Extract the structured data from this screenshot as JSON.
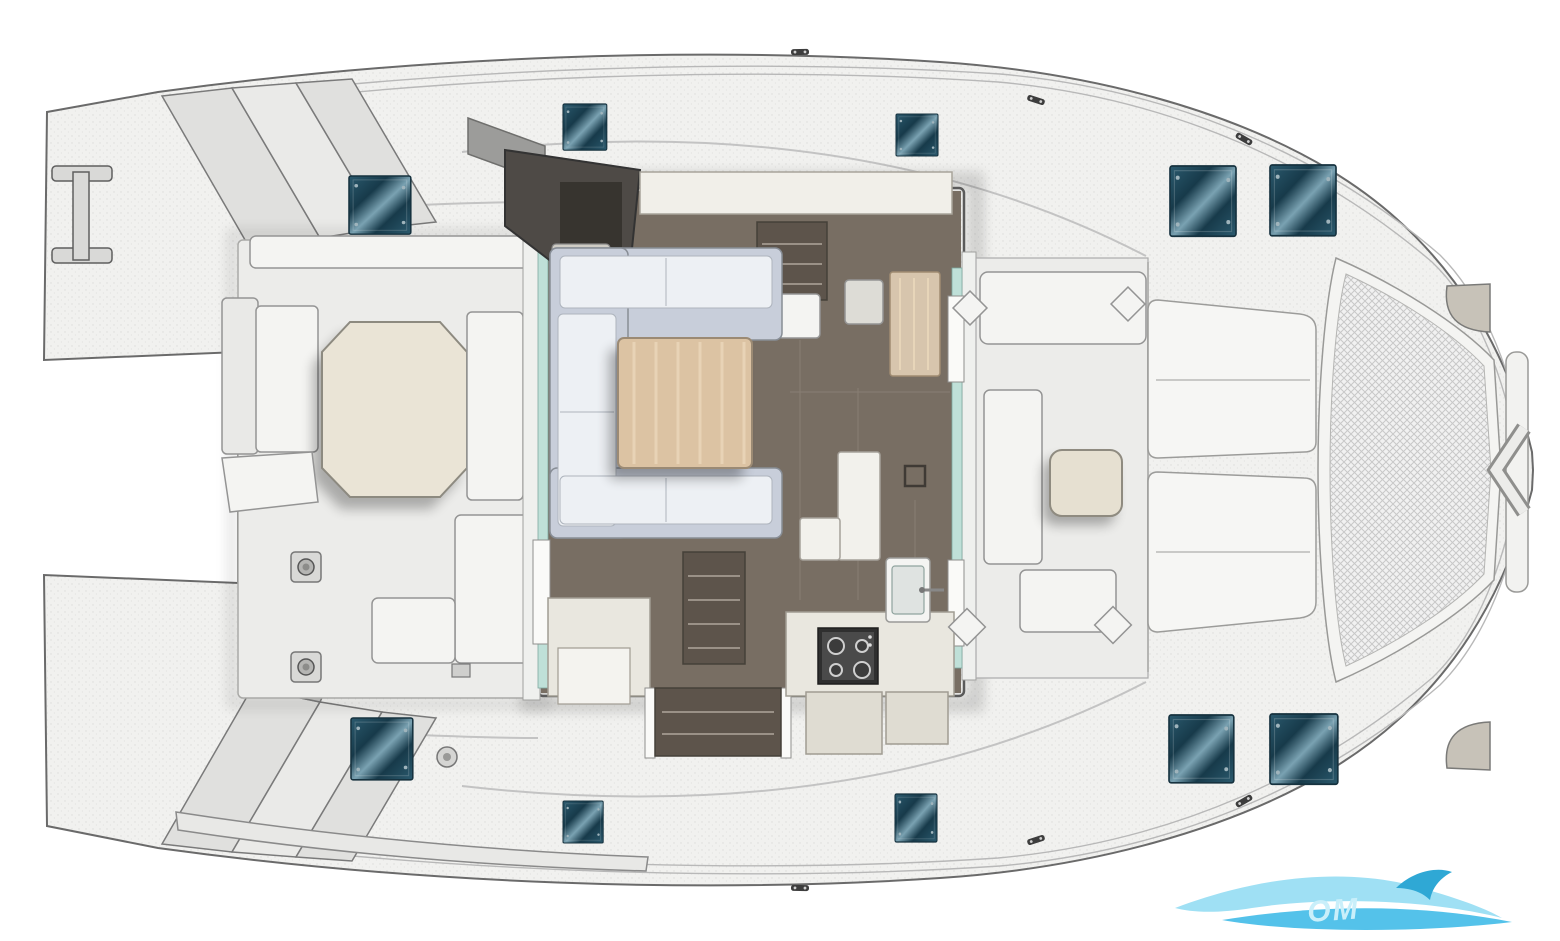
{
  "image": {
    "kind": "boat-deck-floor-plan",
    "subject": "catamaran top view, bow to the right, saloon and cockpits visible"
  },
  "colors": {
    "background": "#ffffff",
    "hull_fill": "#f1f1ef",
    "hull_stroke": "#6a6a6a",
    "deck_speckle": "#dcdcda",
    "cockpit_sole": "#ececea",
    "seat_white": "#f4f4f2",
    "step_gray": "#e0e0de",
    "wedge_gray": "#c2c2c0",
    "salon_floor": "#786e63",
    "floor_seam": "#8d8377",
    "stairs_brown": "#5d544b",
    "sofa_back": "#c8ceda",
    "sofa_cushion": "#edf0f4",
    "salon_table_wood": "#dcc3a3",
    "wood_grain": "#ecd9bd",
    "aft_table_cream": "#eae4d6",
    "fwd_table_cream": "#e6e0d1",
    "helm_dark": "#4e4a46",
    "helm_panel": "#37342f",
    "helm_seat": "#cfccc4",
    "galley_counter": "#e9e7df",
    "galley_cabinet": "#dfdcd2",
    "stove_dark": "#2f2f2f",
    "stove_panel": "#4a4a4a",
    "nav_wood": "#d7c5ad",
    "glass_teal": "#bfe0d8",
    "hatch_mid": "#2b5a6e",
    "hatch_dark": "#173a4a",
    "hatch_sheen": "#7aa2b2",
    "hatch_screw": "#9fb4bc",
    "trampoline_base": "#f1f1f1",
    "trampoline_mesh": "#c8c8c8",
    "fitting_gray": "#c7c2b8",
    "cleat_dark": "#3d3d3d",
    "watermark_light": "#9fe0f4",
    "watermark_mid": "#54c2ea",
    "watermark_dark": "#2fa8d5",
    "watermark_text": "#c9effa"
  },
  "counts": {
    "deck_hatches": 10,
    "stove_burners": 4,
    "transom_steps_per_side": 3,
    "sunpads": 2
  },
  "watermark": {
    "text_fragment": "OM"
  },
  "regions": {
    "stern": [
      "port-transom-steps",
      "starboard-transom-steps",
      "swim-ladder",
      "tender-plank"
    ],
    "aft_cockpit": [
      "cockpit-sole",
      "l-settee",
      "octagonal-table",
      "chaise-bench",
      "aft-bench",
      "winches"
    ],
    "salon": [
      "helm-station",
      "u-shaped-sofa",
      "wood-dining-table",
      "dark-floor",
      "stairs-to-port-hull",
      "stairs-to-starboard-hull",
      "nav-cabinet",
      "galley-counters",
      "stove",
      "sink",
      "entry-steps",
      "floor-hatch"
    ],
    "forward_cockpit": [
      "u-seating",
      "coffee-table"
    ],
    "foredeck": [
      "sunpad-port",
      "sunpad-starboard"
    ],
    "bow": [
      "trampoline-net",
      "bow-crossbeam",
      "bowsprit-chevron",
      "fairleads"
    ]
  }
}
